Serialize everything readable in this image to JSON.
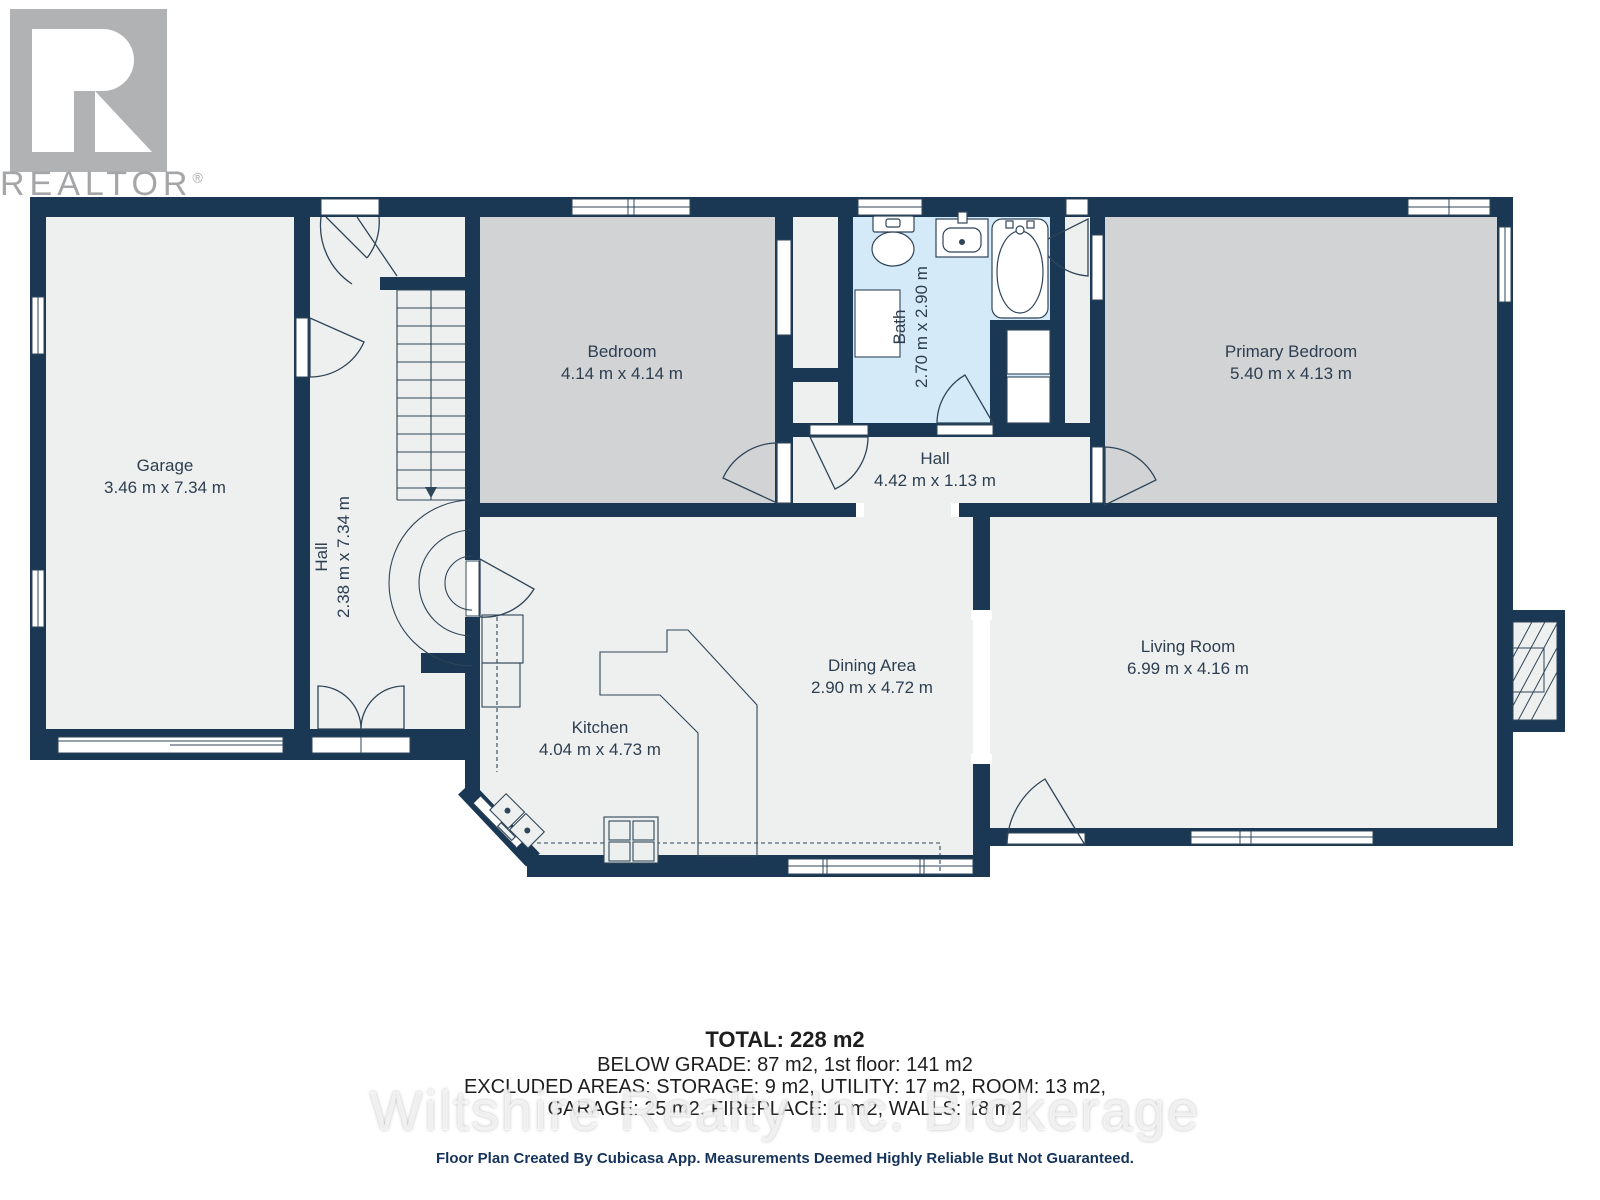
{
  "logo": {
    "brand": "REALTOR",
    "reg": "®"
  },
  "rooms": {
    "garage": {
      "name": "Garage",
      "dims": "3.46 m x 7.34 m"
    },
    "hall_entry": {
      "name": "Hall",
      "dims": "2.38 m x 7.34 m"
    },
    "bedroom": {
      "name": "Bedroom",
      "dims": "4.14 m x 4.14 m"
    },
    "bath": {
      "name": "Bath",
      "dims": "2.70 m x 2.90 m"
    },
    "primary": {
      "name": "Primary Bedroom",
      "dims": "5.40 m x 4.13 m"
    },
    "hall_upper": {
      "name": "Hall",
      "dims": "4.42 m x 1.13 m"
    },
    "kitchen": {
      "name": "Kitchen",
      "dims": "4.04 m x 4.73 m"
    },
    "dining": {
      "name": "Dining Area",
      "dims": "2.90 m x 4.72 m"
    },
    "living": {
      "name": "Living Room",
      "dims": "6.99 m x 4.16 m"
    }
  },
  "summary": {
    "total": "TOTAL: 228 m2",
    "grade": "BELOW GRADE: 87 m2, 1st floor: 141 m2",
    "excluded1": "EXCLUDED AREAS: STORAGE: 9 m2, UTILITY: 17 m2, ROOM: 13 m2,",
    "excluded2": "GARAGE: 25 m2, FIREPLACE: 1 m2, WALLS: 18 m2"
  },
  "watermark": "Wiltshire Realty Inc. Brokerage",
  "footer": "Floor Plan Created By Cubicasa App. Measurements Deemed Highly Reliable But Not Guaranteed.",
  "colors": {
    "wall": "#1a3753",
    "floor": "#eef0ef",
    "bedroom_fill": "#d2d3d5",
    "bath_fill": "#d5eaf9",
    "logo_gray": "#b1b2b4"
  }
}
